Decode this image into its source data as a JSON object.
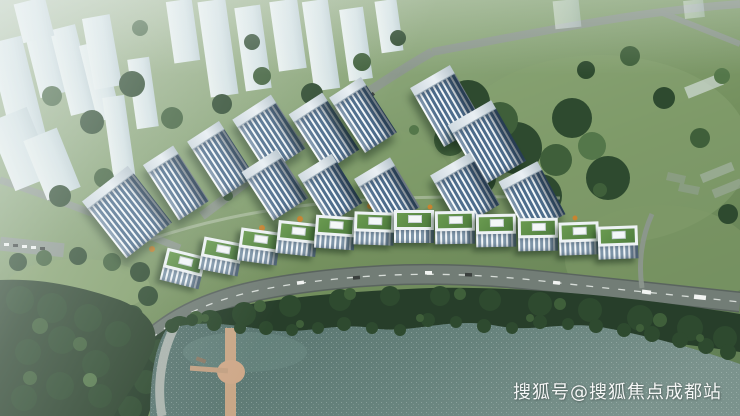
{
  "watermark": {
    "text": "搜狐号@搜狐焦点成都站"
  },
  "scene": {
    "type": "aerial-architectural-rendering",
    "elements": [
      "ghost-city-skyline",
      "residential-towers",
      "green-roof-rowhouses",
      "curved-road",
      "forest",
      "lake",
      "boardwalk-pier",
      "lakeside-path"
    ]
  },
  "palette": {
    "tree-dark": "#2e4a2f",
    "tree-mid": "#3f5f3a",
    "tree-light": "#54774a",
    "forest-deep": "#273e2a",
    "grass-light": "#8ea878",
    "grass-mid": "#74905e",
    "road": "#727d76",
    "road-edge": "#5a645f",
    "road-line": "#e8ece9",
    "ghost-light": "#f3f8fa",
    "ghost-dark": "#c7d6de",
    "tower-white": "#f6fafc",
    "tower-glass": "#4e6d8c",
    "roof-light": "#e9eff3",
    "lawn-roof": "#4f7e3e",
    "house-frame": "#edf2f4",
    "water-dark": "#55716c",
    "water-light": "#7b938d",
    "pier": "#c9a787",
    "autumn": "#c8842f",
    "watermark-color": "#ffffff"
  }
}
